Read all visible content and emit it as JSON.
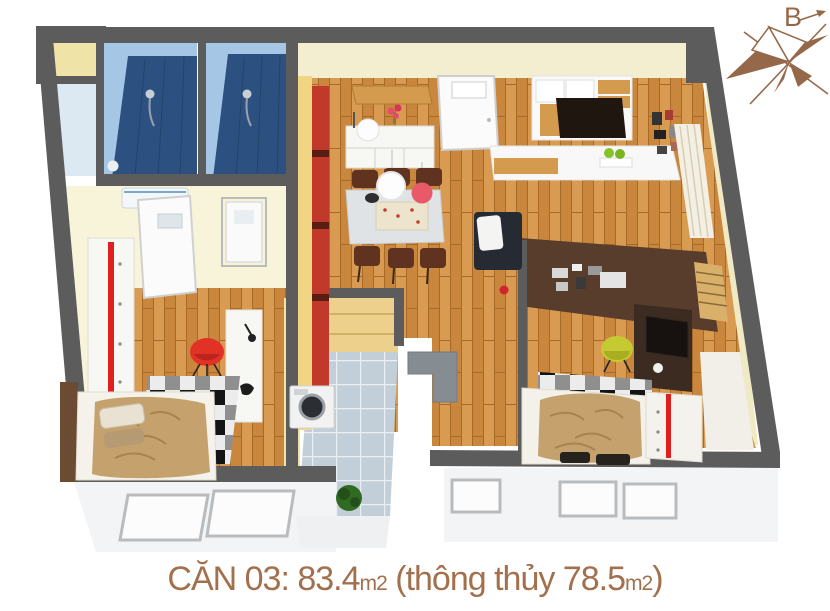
{
  "caption": {
    "full": "CĂN 03: 83.4m2 (thông thủy 78.5m2)",
    "part1": "CĂN 03: 83.4",
    "unit1": "m2",
    "part2": " (thông thủy 78.5",
    "unit2": "m2",
    "part3": ")"
  },
  "compass": {
    "label": "B",
    "icon": "compass-rose-icon"
  },
  "rooms": [
    {
      "id": "bathroom-1",
      "type": "bathroom"
    },
    {
      "id": "bathroom-2",
      "type": "bathroom"
    },
    {
      "id": "living-dining-room",
      "type": "living-dining"
    },
    {
      "id": "kitchen-loggia",
      "type": "kitchen"
    },
    {
      "id": "bedroom-left",
      "type": "bedroom"
    },
    {
      "id": "bedroom-right",
      "type": "bedroom"
    },
    {
      "id": "balcony-left",
      "type": "balcony"
    },
    {
      "id": "balcony-right",
      "type": "balcony"
    }
  ],
  "palette": {
    "wall": "#5c5c5c",
    "cream": "#f2eecf",
    "creambright": "#f8f4da",
    "yellowwall": "#f0e3a8",
    "wood": "#c9873e",
    "woodlight": "#d99a52",
    "wooddark": "#a96a28",
    "cabwood": "#ecd08c",
    "bathlight": "#a5c6e4",
    "bathdark": "#2c5180",
    "tile": "#c2cfd8",
    "brownwall": "#583d2c",
    "blankettan": "#c5a26d",
    "accentred": "#e02020",
    "redchair": "#e23226",
    "yellowchair": "#c5ca33",
    "whitefurn": "#f7f7f4",
    "grayfurn": "#dfe3e6",
    "sofa": "#262a33",
    "counter": "#868d92",
    "balcony": "#f3f4f5",
    "chairbrown": "#5f3320",
    "deskbrown": "#3b2b21",
    "plantgreen": "#2f6b22",
    "compass": "#96684a",
    "caption": "#a3704e"
  }
}
